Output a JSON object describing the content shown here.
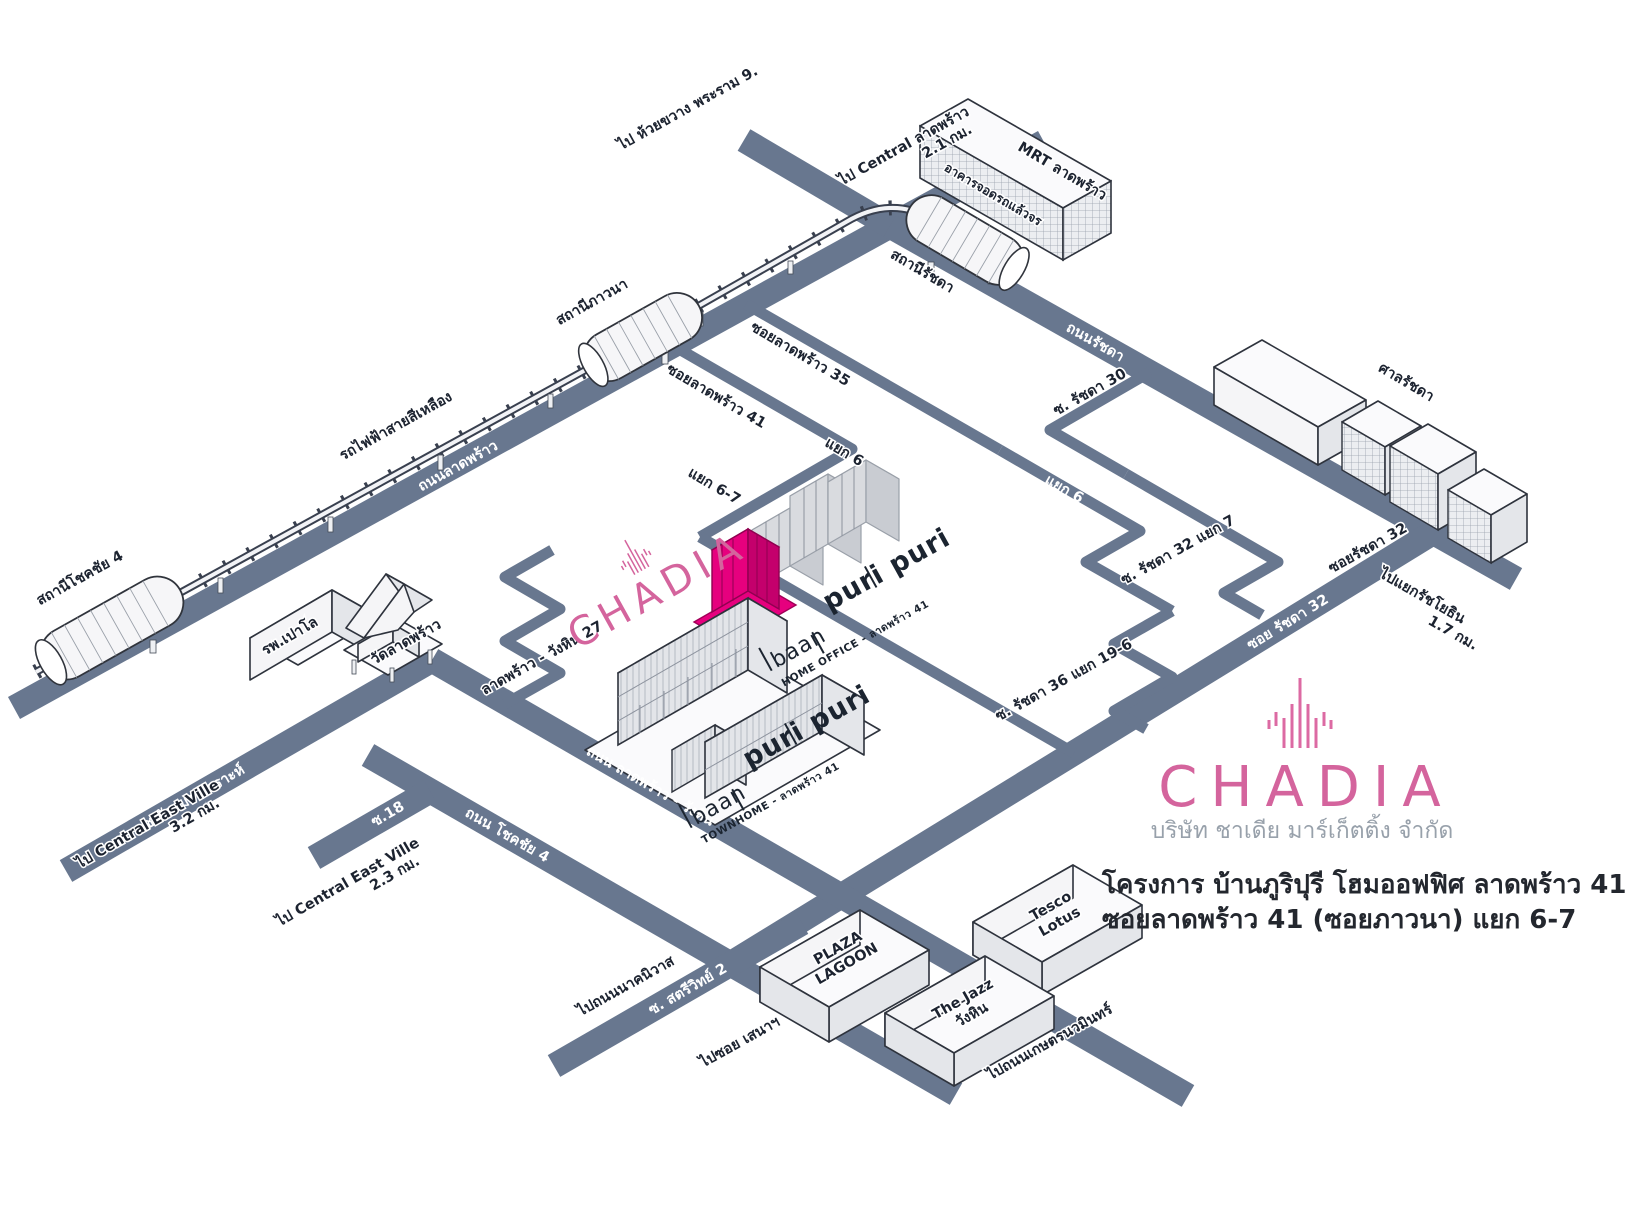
{
  "roads": {
    "ladprao": "ถนนลาดพร้าว",
    "ratchada": "ถนนรัชดา",
    "ladprao_wanghin": "ถนน ลาดพร้าว - วังหิน",
    "chokchai4": "ถนน โชคชัย 4",
    "sangkhom_songkhro": "ซ.สังคมสงเคราะห์",
    "soi18": "ซ.18",
    "satriwit2": "ซ. สตรีวิทย์ 2",
    "soi_ratchada32": "ซอย รัชดา 32",
    "yaek6": "แยก 6"
  },
  "sois": {
    "ladprao35": "ซอยลาดพร้าว 35",
    "ladprao41": "ซอยลาดพร้าว 41",
    "yaek6": "แยก 6",
    "yaek67": "แยก 6-7",
    "ratchada30": "ซ. รัชดา 30",
    "ratchada32": "ซอยรัชดา 32",
    "ratchada32_yaek7": "ซ. รัชดา 32 แยก 7",
    "ratchada36_yaek196": "ซ. รัชดา 36 แยก 19-6",
    "wanghin27": "ลาดพร้าว - วังหิน 27"
  },
  "directions": {
    "huai_khwang": "ไป ห้วยขวาง พระราม 9.",
    "central_ladprao": [
      "ไป Central ลาดพร้าว",
      "2.1 กม."
    ],
    "ratchayothin": [
      "ไปแยกรัชโยธิน",
      "1.7 กม."
    ],
    "central_eastville_32": [
      "ไป Central East Ville",
      "3.2 กม."
    ],
    "central_eastville_23": [
      "ไป Central East Ville",
      "2.3 กม."
    ],
    "nakniwat": "ไปถนนนาคนิวาส",
    "soi_sena": "ไปซอย เสนาฯ",
    "kaset_nawamin": "ไปถนนเกษตรนวมินทร์"
  },
  "stations": {
    "yellow_line": "รถไฟฟ้าสายสีเหลือง",
    "chokchai4": "สถานีโชคชัย 4",
    "phawana": "สถานีภาวนา",
    "ratchada": "สถานีรัชดา",
    "mrt_ladprao": "MRT ลาดพร้าว",
    "park_and_ride": "อาคารจอดรถแล้วจร"
  },
  "places": {
    "paolo_hospital": "รพ.เปาโล",
    "wat_ladprao": "วัดลาดพร้าว",
    "ratchada_court": "ศาลรัชดา",
    "plaza_lagoon": [
      "PLAZA",
      "LAGOON"
    ],
    "tesco_lotus": [
      "Tesco",
      "Lotus"
    ],
    "the_jazz": [
      "The Jazz",
      "วังหิน"
    ]
  },
  "project": {
    "brand": "CHADIA",
    "home_office": {
      "word1": "baan",
      "word2": "puri puri",
      "caption": "HOME OFFICE - ลาดพร้าว 41"
    },
    "townhome": {
      "word1": "baan",
      "word2": "puri puri",
      "caption": "TOWNHOME - ลาดพร้าว 41"
    }
  },
  "legend": {
    "brand": "CHADIA",
    "company": "บริษัท ชาเดีย มาร์เก็ตติ้ง จำกัด",
    "project_line1": "โครงการ บ้านภูริปุรี โฮมออฟฟิศ ลาดพร้าว 41",
    "project_line2": "ซอยลาดพร้าว 41 (ซอยภาวนา) แยก 6-7"
  },
  "colors": {
    "road": "#68778F",
    "brand_pink": "#D4649D",
    "building_magenta": "#E6007E"
  }
}
